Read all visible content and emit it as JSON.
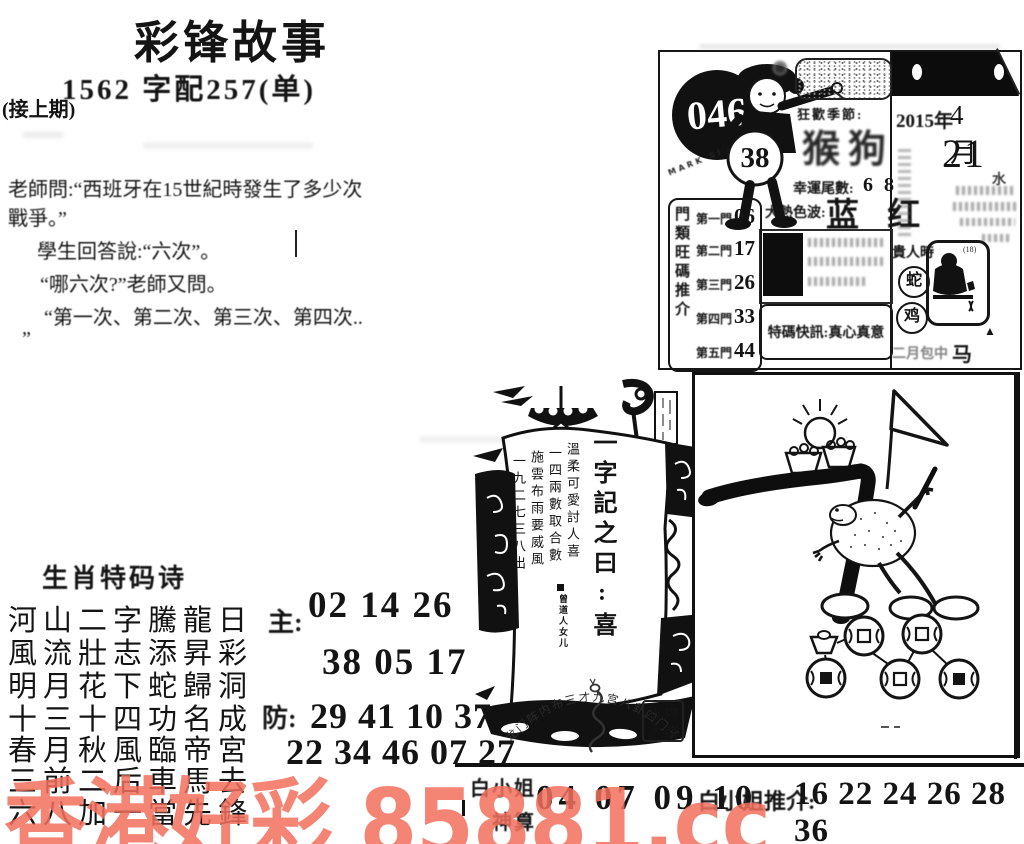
{
  "masthead": {
    "title": "彩锋故事",
    "subtitle": "1562 字配257(单)",
    "continued": "(接上期)"
  },
  "story": {
    "lines": [
      "老師問:“西班牙在15世紀時發生了多少次",
      "戰爭。”",
      "學生回答說:“六次”。",
      "“哪六次?”老師又問。",
      "“第一次、第二次、第三次、第四次..",
      "”"
    ]
  },
  "issue_card": {
    "issue_number": "046",
    "ring_text": "MARK SIX",
    "ball_number": "38",
    "season_label": "狂歡季節:",
    "season_value": "猴狗",
    "tail_label": "幸運尾數:",
    "tail_value": "6 8",
    "color_label": "大熱色波:",
    "color_value": "蓝 红",
    "special_news": "特碼快訊:真心真意",
    "doors_side_label": "門類旺碼推介",
    "doors": [
      {
        "name": "第一門",
        "num": "06"
      },
      {
        "name": "第二門",
        "num": "17"
      },
      {
        "name": "第三門",
        "num": "26"
      },
      {
        "name": "第四門",
        "num": "33"
      },
      {
        "name": "第五門",
        "num": "44"
      }
    ]
  },
  "calendar": {
    "year": "2015年",
    "month": "4 月",
    "day": "21",
    "water_char": "水",
    "noble_label": "貴人時",
    "zodiac_a": "蛇",
    "zodiac_b": "鸡",
    "corner_note": "(18)",
    "bottom_smudge": "二月包中",
    "bottom_zodiac": "马 狗",
    "triangle": "▲"
  },
  "ship": {
    "motto": "一字記之曰:喜",
    "verse1": "溫柔可愛討人喜",
    "verse2": "一四兩數取合數",
    "verse3": "施雲布雨要威風",
    "verse4": "一九二七三八出",
    "signature": "曾道人女儿",
    "seal_arc": "龙门阵内布三才九宫八卦四门开",
    "stamp_tl": "心",
    "stamp_tr": "内",
    "stamp_bl": "水",
    "stamp_br": "部"
  },
  "poem": {
    "title": "生肖特码诗",
    "lines": [
      "河山二字騰龍日",
      "風流壯志添昇彩",
      "明月花下蛇歸洞",
      "十三十四功名成",
      "春月秋風臨帝宮",
      "三前二后車馬去",
      "六八加一當先鋒"
    ],
    "main_label": "主:",
    "main1": "02 14 26",
    "main2": "38 05 17",
    "guard_label": "防:",
    "guard1": "29 41 10 37",
    "guard2": "22 34 46 07 27"
  },
  "bottom_strip": {
    "name_line1": "白小姐",
    "name_line2": "神算",
    "numbers": "04 07 09 10",
    "intro_label": "白小姐推介:",
    "intro_numbers": "16 22 24 26 28 36"
  },
  "watermark": {
    "text": "香港好彩 85881.cc",
    "color": "#f3705e"
  }
}
